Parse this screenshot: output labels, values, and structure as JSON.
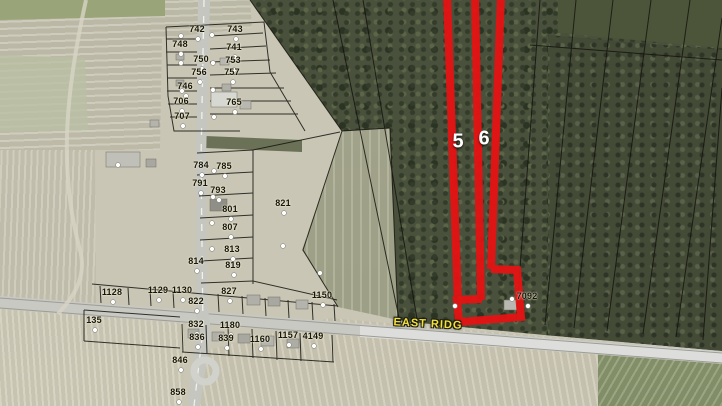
{
  "map": {
    "selected_parcels": [
      {
        "label": "5"
      },
      {
        "label": "6"
      }
    ],
    "road_label": {
      "text": "EAST RIDG"
    },
    "colors": {
      "highlight": "#e51313",
      "parcel_label": "#16160e",
      "road_label": "#f2e23a"
    },
    "parcel_numbers": [
      {
        "text": "742",
        "x": 197,
        "y": 29
      },
      {
        "text": "743",
        "x": 235,
        "y": 29
      },
      {
        "text": "748",
        "x": 180,
        "y": 44
      },
      {
        "text": "741",
        "x": 234,
        "y": 47
      },
      {
        "text": "750",
        "x": 201,
        "y": 59
      },
      {
        "text": "753",
        "x": 233,
        "y": 60
      },
      {
        "text": "756",
        "x": 199,
        "y": 72
      },
      {
        "text": "757",
        "x": 232,
        "y": 72
      },
      {
        "text": "746",
        "x": 185,
        "y": 86
      },
      {
        "text": "706",
        "x": 181,
        "y": 101
      },
      {
        "text": "765",
        "x": 234,
        "y": 102
      },
      {
        "text": "707",
        "x": 182,
        "y": 116
      },
      {
        "text": "784",
        "x": 201,
        "y": 165
      },
      {
        "text": "785",
        "x": 224,
        "y": 166
      },
      {
        "text": "791",
        "x": 200,
        "y": 183
      },
      {
        "text": "793",
        "x": 218,
        "y": 190
      },
      {
        "text": "801",
        "x": 230,
        "y": 209
      },
      {
        "text": "821",
        "x": 283,
        "y": 203
      },
      {
        "text": "807",
        "x": 230,
        "y": 227
      },
      {
        "text": "813",
        "x": 232,
        "y": 249
      },
      {
        "text": "814",
        "x": 196,
        "y": 261
      },
      {
        "text": "819",
        "x": 233,
        "y": 265
      },
      {
        "text": "827",
        "x": 229,
        "y": 291
      },
      {
        "text": "822",
        "x": 196,
        "y": 301
      },
      {
        "text": "1128",
        "x": 112,
        "y": 292
      },
      {
        "text": "1129",
        "x": 158,
        "y": 290
      },
      {
        "text": "1130",
        "x": 182,
        "y": 290
      },
      {
        "text": "135",
        "x": 94,
        "y": 320
      },
      {
        "text": "832",
        "x": 196,
        "y": 324
      },
      {
        "text": "1180",
        "x": 230,
        "y": 325
      },
      {
        "text": "836",
        "x": 197,
        "y": 337
      },
      {
        "text": "839",
        "x": 226,
        "y": 338
      },
      {
        "text": "1160",
        "x": 260,
        "y": 339
      },
      {
        "text": "1157",
        "x": 288,
        "y": 335
      },
      {
        "text": "4149",
        "x": 313,
        "y": 336
      },
      {
        "text": "846",
        "x": 180,
        "y": 360
      },
      {
        "text": "858",
        "x": 178,
        "y": 392
      },
      {
        "text": "1150",
        "x": 322,
        "y": 295
      },
      {
        "text": "7092",
        "x": 527,
        "y": 296
      }
    ]
  }
}
